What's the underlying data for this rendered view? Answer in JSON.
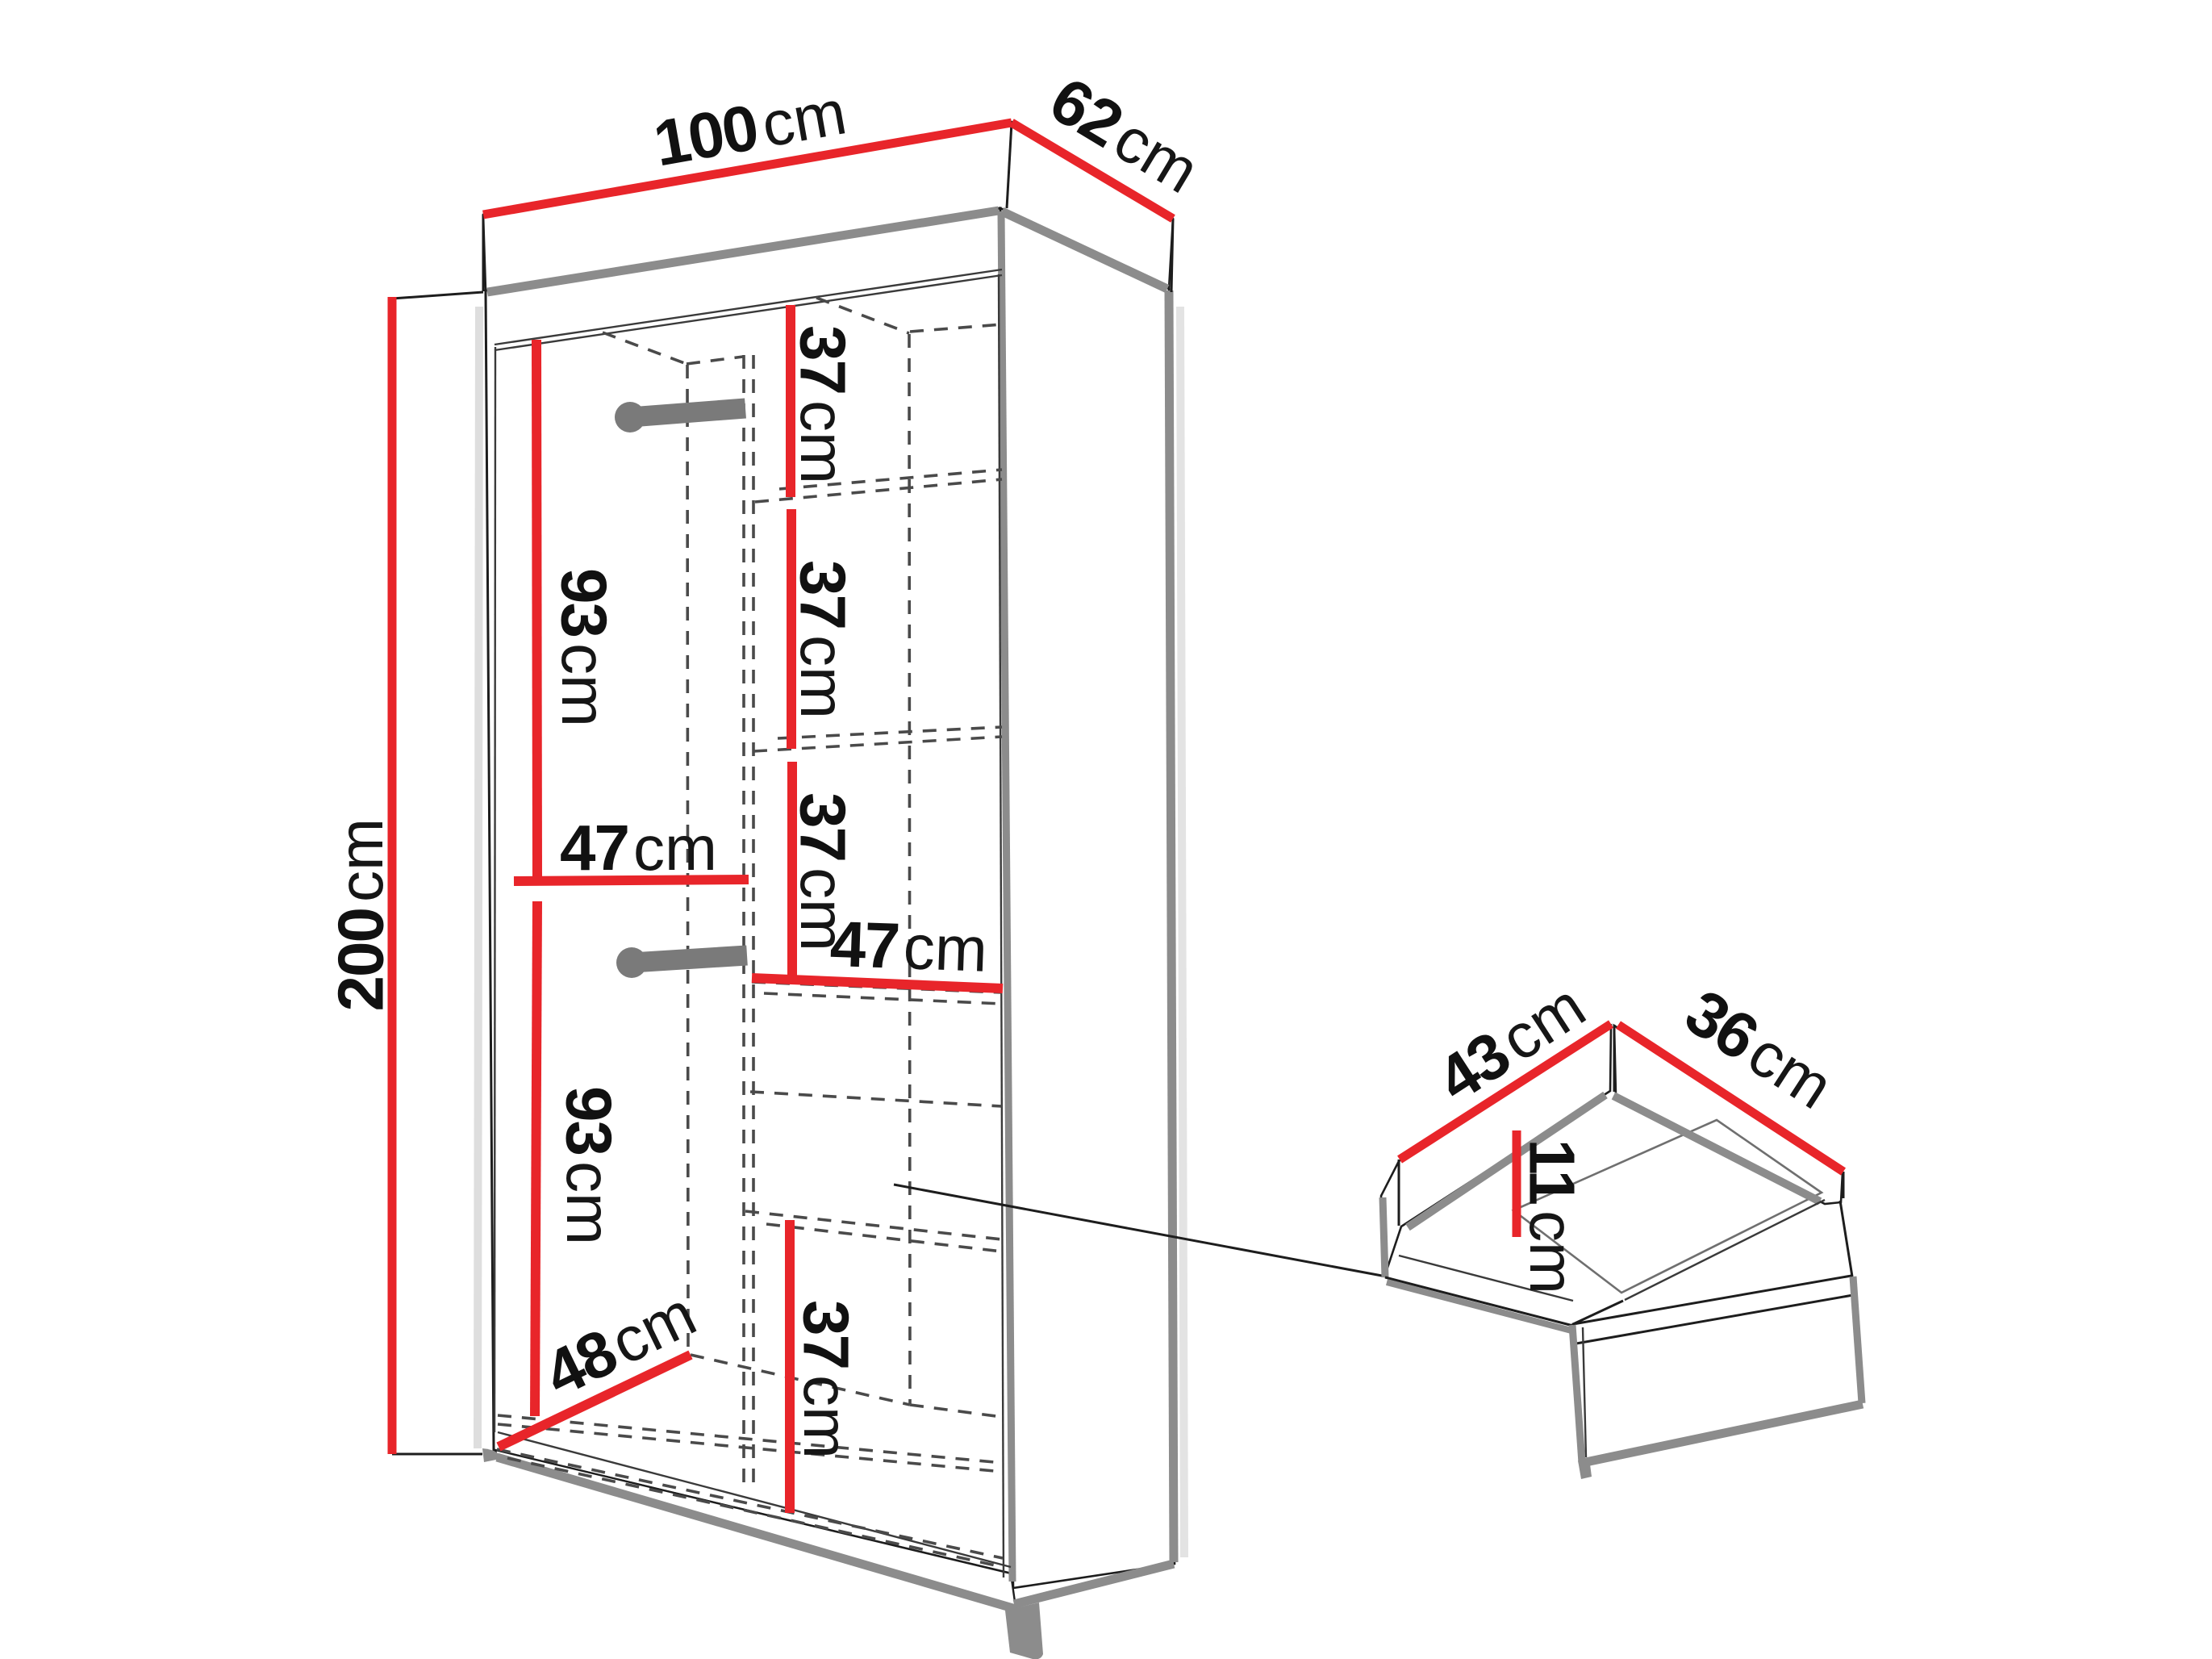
{
  "title": "Wardrobe technical drawing with dimensions and drawer detail",
  "unit_default": "cm",
  "colors": {
    "dimension_red": "#e8252a",
    "edge_gray": "#8c8c8c",
    "line_black": "#1d1d1d",
    "dash_gray": "#4a4a4a",
    "background": "#ffffff"
  },
  "wardrobe": {
    "outer": {
      "top_width": {
        "value": "100",
        "unit": "cm"
      },
      "top_depth": {
        "value": "62",
        "unit": "cm"
      },
      "height": {
        "value": "200",
        "unit": "cm"
      }
    },
    "interior": {
      "hanging_upper_height": {
        "value": "93",
        "unit": "cm"
      },
      "hanging_lower_height": {
        "value": "93",
        "unit": "cm"
      },
      "shelf_gap_1": {
        "value": "37",
        "unit": "cm"
      },
      "shelf_gap_2": {
        "value": "37",
        "unit": "cm"
      },
      "shelf_gap_3": {
        "value": "37",
        "unit": "cm"
      },
      "shelf_gap_bottom": {
        "value": "37",
        "unit": "cm"
      },
      "left_section_width": {
        "value": "47",
        "unit": "cm"
      },
      "right_section_width": {
        "value": "47",
        "unit": "cm"
      },
      "left_section_depth": {
        "value": "48",
        "unit": "cm"
      }
    }
  },
  "drawer": {
    "depth": {
      "value": "43",
      "unit": "cm"
    },
    "width": {
      "value": "36",
      "unit": "cm"
    },
    "height": {
      "value": "11",
      "unit": "cm"
    }
  }
}
